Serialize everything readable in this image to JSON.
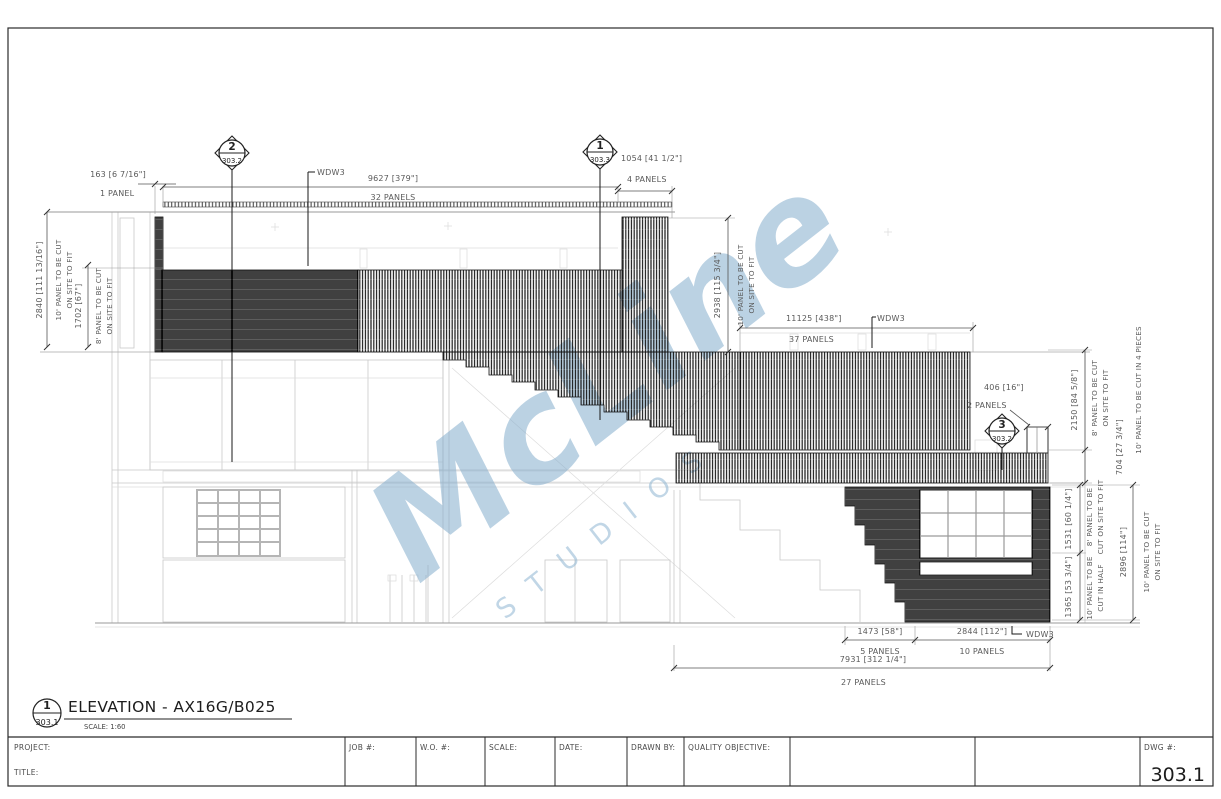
{
  "view": {
    "bubble_number": "1",
    "bubble_sheet": "303.1",
    "title": "ELEVATION - AX16G/B025",
    "scale": "SCALE: 1:60"
  },
  "watermark": {
    "word": "McLine",
    "sub": "STUDIOS",
    "color": "#8ab2d2"
  },
  "callouts": {
    "c2_num": "2",
    "c2_sheet": "303.2",
    "c1_num": "1",
    "c1_sheet": "303.3",
    "c3_num": "3",
    "c3_sheet": "303.2"
  },
  "dims": {
    "wdw3": "WDW3",
    "d163": "163 [6 7/16\"]",
    "p1": "1 PANEL",
    "d9627": "9627 [379\"]",
    "p32": "32 PANELS",
    "d1054": "1054 [41 1/2\"]",
    "p4": "4 PANELS",
    "d2840": "2840 [111 13/16\"]",
    "d1702": "1702 [67\"]",
    "d2938": "2938 [115 3/4\"]",
    "d11125": "11125 [438\"]",
    "p37": "37 PANELS",
    "d406": "406 [16\"]",
    "p2": "2 PANELS",
    "d2150": "2150 [84 5/8\"]",
    "d704": "704 [27 3/4\"]",
    "d1531": "1531 [60 1/4\"]",
    "d1365": "1365 [53 3/4\"]",
    "d2896": "2896 [114\"]",
    "d1473": "1473 [58\"]",
    "p5": "5 PANELS",
    "d2844": "2844 [112\"]",
    "p10": "10 PANELS",
    "d7931": "7931 [312 1/4\"]",
    "p27": "27 PANELS"
  },
  "notes": {
    "cut10": "10' PANEL TO BE CUT",
    "cut8": "8' PANEL TO BE CUT",
    "onsite": "ON SITE TO FIT",
    "cut10_4pieces": "10' PANEL TO BE CUT IN 4 PIECES",
    "tobe8": "8' PANEL TO BE",
    "cut_onsite": "CUT ON SITE TO FIT",
    "tobe10": "10' PANEL TO BE",
    "cut_half": "CUT IN HALF"
  },
  "title_block": {
    "project": "PROJECT:",
    "title": "TITLE:",
    "job": "JOB #:",
    "wo": "W.O. #:",
    "scale": "SCALE:",
    "date": "DATE:",
    "drawn_by": "DRAWN BY:",
    "quality": "QUALITY OBJECTIVE:",
    "dwg": "DWG #:",
    "dwg_number": "303.1"
  }
}
